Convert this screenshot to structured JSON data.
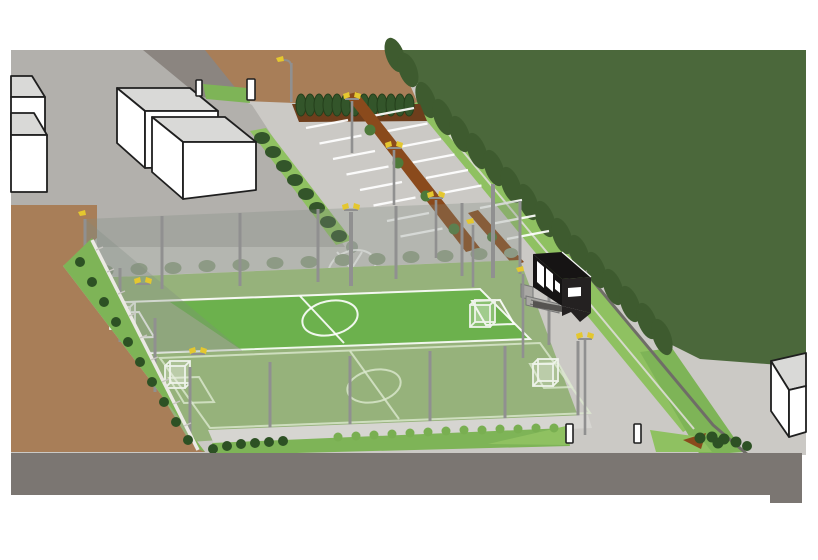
{
  "image": {
    "kind": "axonometric landscape-architecture site rendering",
    "subject": "Fenced twin mini football pitches with floodlights, parking lot with planted medians, hedge rows, dense tree screen, access roads, bollards and surrounding massing-model buildings"
  },
  "scene": {
    "features": [
      "two artificial-turf mini pitches with white line markings, centre circles and four goals",
      "perimeter ball-stop fence with grey posts and translucent mesh",
      "floodlight and street-light poles with yellow luminaires",
      "parking lot with white stall striping and two brown planted median strips",
      "clipped cypress hedge row on dark soil bed",
      "diagonal shrub hedge with stone sphere separating plaza from parking",
      "dense dark-green tree screen along the boulevard with light green verge and footpath line",
      "black clubhouse pavilion with white windows, steps and notched canopy",
      "white box massing buildings (three at top-left, one partial at left edge, one at bottom-right)",
      "earth embankment with shrubs and white stepped retaining edge",
      "grey access road (top-left), wide asphalt road along the bottom",
      "four white access bollards",
      "painted circle marking on the forecourt pavement"
    ],
    "counts": {
      "goals": 4,
      "bollards": 4,
      "parking_medians": 2,
      "pitches": 2
    }
  },
  "palette": {
    "page_bg": "#ffffff",
    "pavement": "#cbc9c5",
    "plaza": "#b2b0ac",
    "walkway": "#d6d5d1",
    "road": "#7b7672",
    "access_road": "#8b8580",
    "curb": "#6f6d67",
    "dirt": "#a87e58",
    "soil_bed": "#6e3e1c",
    "median_brown": "#8a4a1c",
    "forest": "#4b683b",
    "tree_scallop": "#3e5b2f",
    "hedge_dark": "#33552a",
    "strip_green": "#8fc161",
    "slope_green": "#7eb457",
    "bush_dark": "#2d5124",
    "bush_light": "#79af51",
    "bush_muted": "#8d9a85",
    "field_bright": "#6cb14d",
    "field_muted": "#96b27b",
    "line_white": "#ffffff",
    "line_soft": "#dce8cf",
    "fence_tint": "rgba(130,138,130,0.30)",
    "post_gray": "#909090",
    "lamp_yellow": "#e4c72f",
    "bld_face": "#ffffff",
    "bld_roof": "#d9d9d7",
    "bld_outline": "#1f1f1f",
    "dark_bld": "#161414",
    "dark_bld_side": "#242121",
    "window_white": "#ffffff",
    "bollard_face": "#ffffff",
    "step_wall": "#ebe9e4",
    "step_tick": "#c9c7c2",
    "sphere_gray": "#9aa296",
    "path_light": "#d9dbd0",
    "goal_white": "#eef3ea",
    "goal_fill": "rgba(245,248,242,0.22)",
    "deck_gray": "#a9a8a4"
  }
}
